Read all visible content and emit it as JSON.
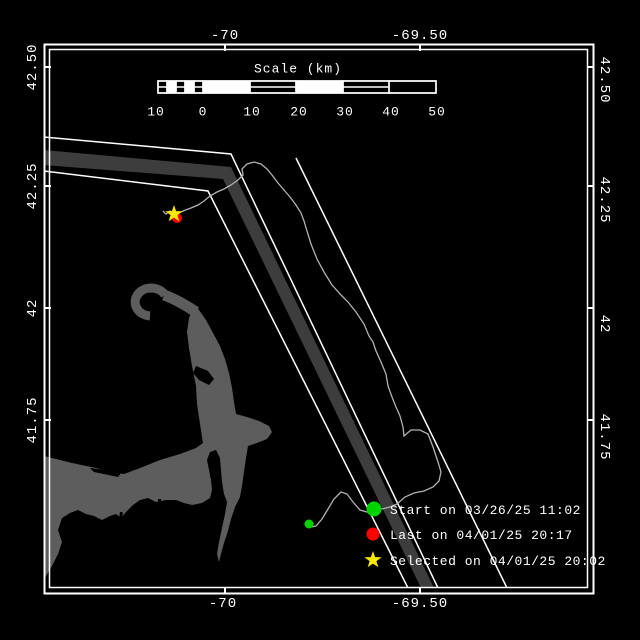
{
  "map": {
    "description": "Black nautical tracking map of Cape Cod region with traffic separation scheme lanes, a vessel/whale track, and start/last/selected markers",
    "land_name": "cape-cod",
    "markers": [
      {
        "name": "start-marker",
        "shape": "green-dot"
      },
      {
        "name": "last-marker",
        "shape": "red-dot"
      },
      {
        "name": "selected-marker",
        "shape": "yellow-star"
      }
    ]
  },
  "axes": {
    "top": [
      "-70",
      "-69.50"
    ],
    "bottom": [
      "-70",
      "-69.50"
    ],
    "left": [
      "42.50",
      "42.25",
      "42",
      "41.75"
    ],
    "right": [
      "42.50",
      "42.25",
      "42",
      "41.75"
    ]
  },
  "scalebar": {
    "title": "Scale (km)",
    "labels": [
      "10",
      "0",
      "10",
      "20",
      "30",
      "40",
      "50"
    ]
  },
  "legend": {
    "items": [
      {
        "marker": "green-dot",
        "label": "Start on 03/26/25 11:02"
      },
      {
        "marker": "red-dot",
        "label": "Last on 04/01/25 20:17"
      },
      {
        "marker": "yellow-star",
        "label": "Selected on 04/01/25 20:02"
      }
    ]
  },
  "colors": {
    "background": "#000000",
    "frame": "#ffffff",
    "land": "#5d5d5d",
    "separation_zone": "#3d3d3d",
    "lane_line": "#ffffff",
    "track": "#b2b2b2",
    "start": "#00d400",
    "last": "#ff0000",
    "selected": "#ffe800",
    "text": "#ffffff"
  }
}
